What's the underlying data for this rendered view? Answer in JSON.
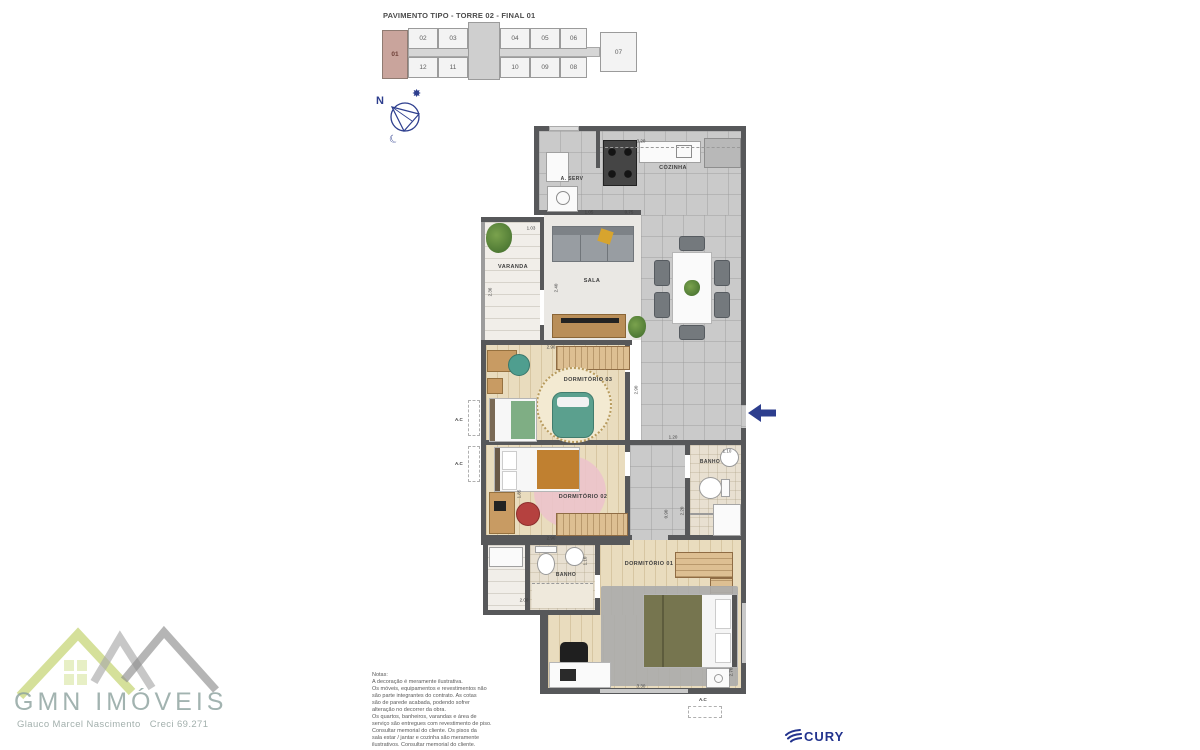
{
  "keyplan": {
    "title": "PAVIMENTO TIPO - TORRE 02 - FINAL 01",
    "highlighted_unit": "01",
    "units": [
      {
        "label": "01"
      },
      {
        "label": "02"
      },
      {
        "label": "03"
      },
      {
        "label": "04"
      },
      {
        "label": "05"
      },
      {
        "label": "06"
      },
      {
        "label": "07"
      },
      {
        "label": "08"
      },
      {
        "label": "09"
      },
      {
        "label": "10"
      },
      {
        "label": "11"
      },
      {
        "label": "12"
      }
    ]
  },
  "compass": {
    "north_label": "N",
    "sun_icon": "✸",
    "moon_icon": "☾"
  },
  "floorplan": {
    "rooms": [
      {
        "label": "A. SERV"
      },
      {
        "label": "COZINHA"
      },
      {
        "label": "VARANDA"
      },
      {
        "label": "SALA"
      },
      {
        "label": "DORMITÓRIO 03"
      },
      {
        "label": "DORMITÓRIO 02"
      },
      {
        "label": "BANHO"
      },
      {
        "label": "BANHO"
      },
      {
        "label": "DORMITÓRIO 01"
      }
    ],
    "dimensions": [
      {
        "text": "3.20"
      },
      {
        "text": "1.05"
      },
      {
        "text": "0.75"
      },
      {
        "text": "1.03"
      },
      {
        "text": "2.36"
      },
      {
        "text": "2.40"
      },
      {
        "text": "2.90"
      },
      {
        "text": "2.90"
      },
      {
        "text": "1.85"
      },
      {
        "text": "2.90"
      },
      {
        "text": "1.20"
      },
      {
        "text": "1.10"
      },
      {
        "text": "0.90"
      },
      {
        "text": "2.20"
      },
      {
        "text": "2.00"
      },
      {
        "text": "1.10"
      },
      {
        "text": "3.30"
      },
      {
        "text": "2.70"
      }
    ],
    "ac_labels": [
      "A.C",
      "A.C",
      "A.C"
    ]
  },
  "notes": {
    "lines": [
      "Notas:",
      "A decoração é meramente ilustrativa.",
      "Os móveis, equipamentos e revestimentos não",
      "são parte integrantes do contrato. As cotas",
      "são de parede acabada, podendo sofrer",
      "alteração no decorrer da obra.",
      "Os quartos, banheiros, varandas e área de",
      "serviço são entregues com revestimento de piso.",
      "Consultar memorial do cliente. Os pisos da",
      "sala estar / jantar e cozinha são meramente",
      "ilustrativos. Consultar memorial do cliente."
    ]
  },
  "footer": {
    "gmn_name": "GMN IMÓVEIS",
    "gmn_subtitle": "Glauco Marcel Nascimento   Creci 69.271",
    "cury_name": "CURY"
  },
  "colors": {
    "accent_navy": "#2d3e8e",
    "unit_highlight": "#c9a49c",
    "wall": "#57585a",
    "gmn_green": "#b9cb57"
  }
}
